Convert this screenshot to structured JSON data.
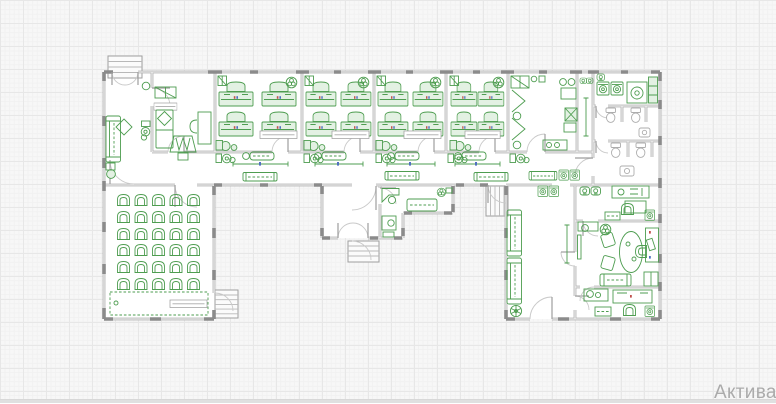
{
  "app": {
    "type": "cad-floor-plan-canvas"
  },
  "watermark": {
    "text": "Актива",
    "color": "#ababab",
    "font_size_px": 19
  },
  "palette": {
    "canvasBg": "#f7f7f7",
    "gridMinor": "#f1f1f1",
    "gridMajor": "#e7e7e7",
    "wall": "#b2b2b2",
    "wallDark": "#8b8b8b",
    "wallGlaze": "#f5f5f5",
    "green": "#4e9d50",
    "greenFill": "#e3f1e3",
    "fixture": "#adadad",
    "arc": "#c9c9c9",
    "leaf": "#9e9e9e",
    "labelBorder": "#9a9a9a",
    "accentRed": "#c0504d",
    "accentBlue": "#4f6fc0",
    "stairBorder": "#9f9f9f",
    "stairTread": "#b8b8b8",
    "watermark": "#ababab",
    "bottomEdge": "#e0e0e0"
  },
  "plan": {
    "type": "architectural-floor-plan",
    "rooms": [
      "entrance-hall",
      "staff-room",
      "classroom-1",
      "classroom-2",
      "classroom-3",
      "classroom-4",
      "art-room",
      "washroom",
      "laundry",
      "wc-1",
      "wc-2",
      "assembly-hall",
      "vestibule",
      "reception",
      "lobby-hall",
      "staff-kitchen",
      "director-office",
      "back-office"
    ],
    "classrooms": {
      "count": 4,
      "double_desks_each": 4
    },
    "assembly_hall": {
      "seat_rows": 6,
      "seat_cols": 5
    },
    "exterior_stairs_count": 4,
    "label_boxes_count": 5
  }
}
